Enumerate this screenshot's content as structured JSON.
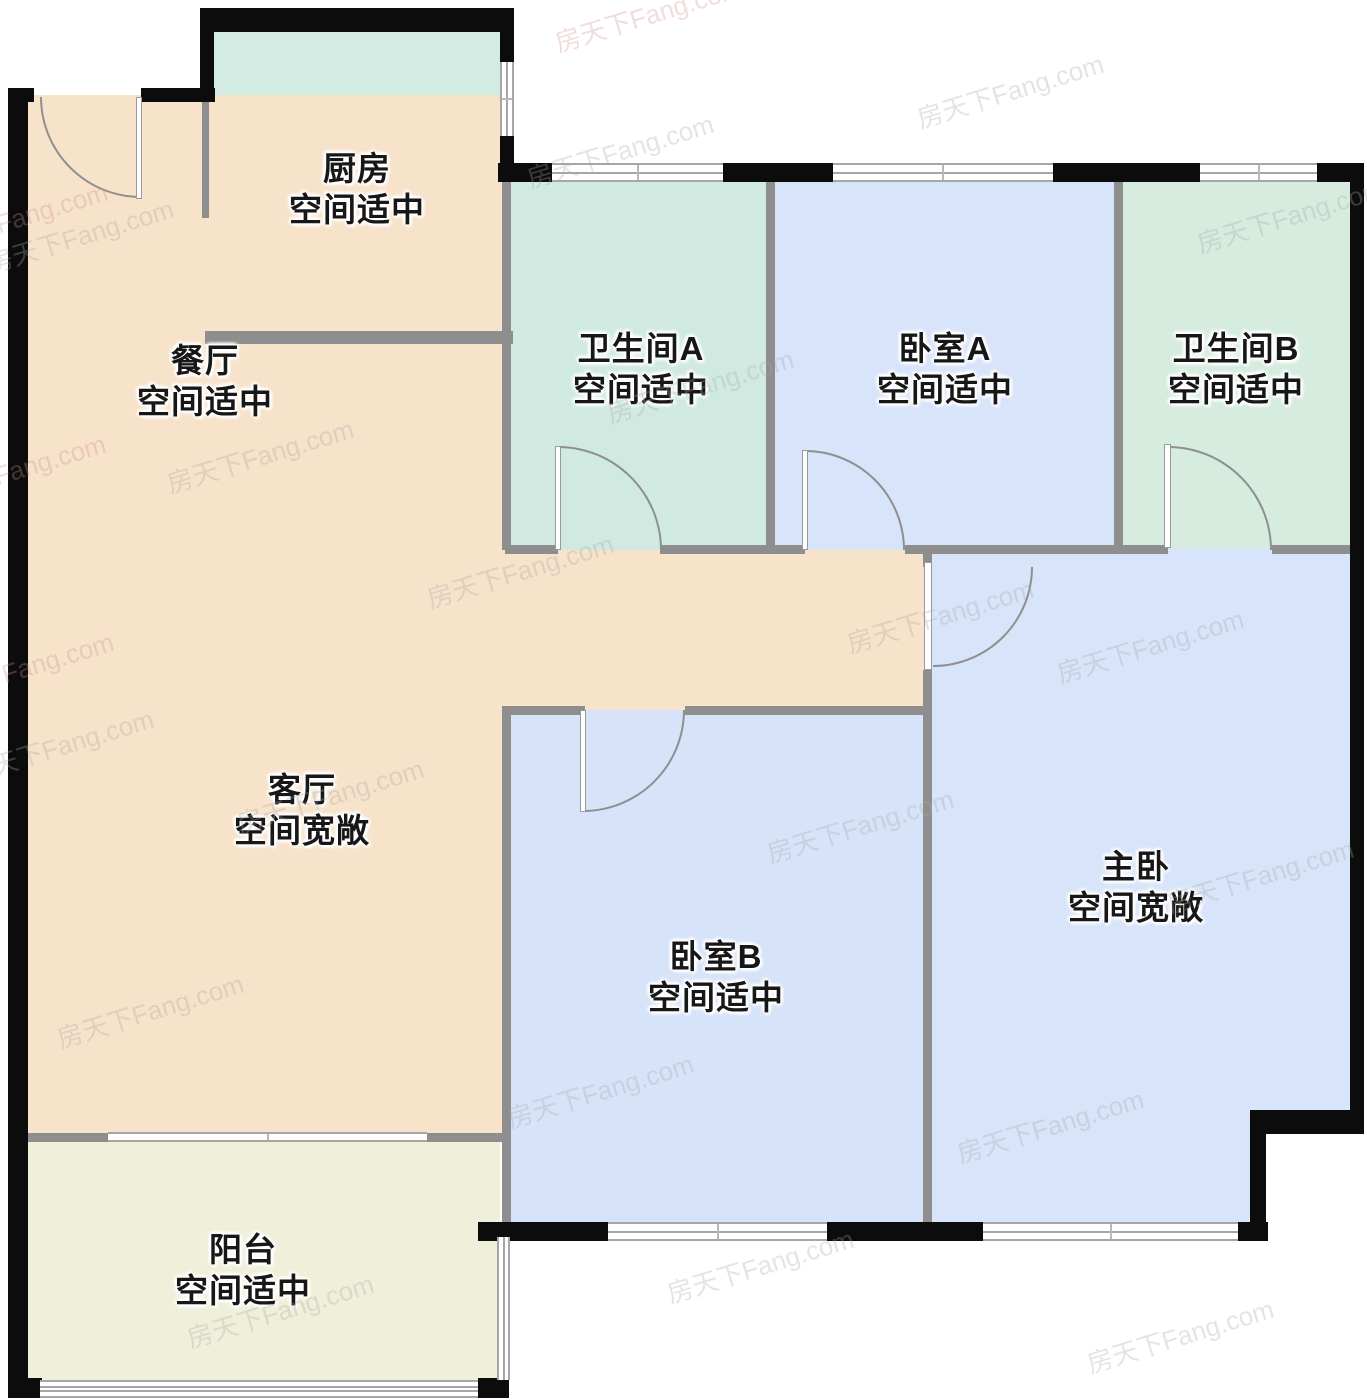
{
  "canvas": {
    "w": 1367,
    "h": 1400,
    "bg": "#ffffff"
  },
  "palette": {
    "outer_wall": "#0c0c0c",
    "partition": "#8e8e8e",
    "window_line": "#a6a6a6",
    "window_fill": "#ffffff",
    "door_line": "#8f8f8f",
    "label_color": "#171717",
    "kitchen_fill": "#d3ece3",
    "bath_fill": "#d0eae2",
    "bedroom_fill": "#d8e4f9",
    "living_fill": "#f7e2ca",
    "balcony_fill": "#f0efda"
  },
  "watermark": {
    "text": "房天下Fang.com",
    "color": "#a8a8a8",
    "opacity": 0.3,
    "accent_color": "#cf9090",
    "accent_opacity": 0.3,
    "positions": [
      [
        80,
        235
      ],
      [
        620,
        150
      ],
      [
        1010,
        90
      ],
      [
        1290,
        215
      ],
      [
        260,
        455
      ],
      [
        700,
        385
      ],
      [
        1150,
        645
      ],
      [
        60,
        745
      ],
      [
        520,
        570
      ],
      [
        940,
        615
      ],
      [
        330,
        795
      ],
      [
        860,
        825
      ],
      [
        1260,
        875
      ],
      [
        150,
        1010
      ],
      [
        600,
        1090
      ],
      [
        1050,
        1125
      ],
      [
        280,
        1310
      ],
      [
        760,
        1265
      ],
      [
        1180,
        1335
      ]
    ],
    "accent_positions": [
      [
        648,
        14
      ],
      [
        14,
        218
      ],
      [
        12,
        470
      ],
      [
        20,
        668
      ]
    ]
  },
  "rooms": [
    {
      "id": "kitchen",
      "name": "厨房",
      "note": "空间适中",
      "cx": 357,
      "cy": 189
    },
    {
      "id": "dining",
      "name": "餐厅",
      "note": "空间适中",
      "cx": 205,
      "cy": 381
    },
    {
      "id": "bath-a",
      "name": "卫生间A",
      "note": "空间适中",
      "cx": 641,
      "cy": 369
    },
    {
      "id": "bed-a",
      "name": "卧室A",
      "note": "空间适中",
      "cx": 945,
      "cy": 369
    },
    {
      "id": "bath-b",
      "name": "卫生间B",
      "note": "空间适中",
      "cx": 1236,
      "cy": 369
    },
    {
      "id": "living",
      "name": "客厅",
      "note": "空间宽敞",
      "cx": 302,
      "cy": 810
    },
    {
      "id": "bed-b",
      "name": "卧室B",
      "note": "空间适中",
      "cx": 716,
      "cy": 977
    },
    {
      "id": "master",
      "name": "主卧",
      "note": "空间宽敞",
      "cx": 1136,
      "cy": 887
    },
    {
      "id": "balcony",
      "name": "阳台",
      "note": "空间适中",
      "cx": 243,
      "cy": 1270
    }
  ],
  "areas": [
    {
      "id": "kitchen-floor",
      "color": "#d3ece3",
      "rect": [
        205,
        25,
        302,
        318
      ]
    },
    {
      "id": "dining-living-floor",
      "color": "#f7e2ca",
      "rect": [
        25,
        95,
        484,
        1046
      ]
    },
    {
      "id": "hall-floor",
      "color": "#f7e2ca",
      "rect": [
        505,
        548,
        420,
        162
      ]
    },
    {
      "id": "bath-a-floor",
      "color": "#d0eae2",
      "rect": [
        505,
        178,
        266,
        372
      ]
    },
    {
      "id": "bed-a-floor",
      "color": "#d8e4f9",
      "rect": [
        766,
        178,
        353,
        372
      ]
    },
    {
      "id": "bath-b-floor",
      "color": "#d6ecdf",
      "rect": [
        1118,
        178,
        240,
        372
      ]
    },
    {
      "id": "master-floor",
      "color": "#d8e4f9",
      "rect": [
        927,
        548,
        431,
        684
      ]
    },
    {
      "id": "bed-b-floor",
      "color": "#d6e3f8",
      "rect": [
        505,
        710,
        420,
        522
      ]
    },
    {
      "id": "balcony-floor",
      "color": "#f0efda",
      "rect": [
        25,
        1138,
        475,
        250
      ]
    },
    {
      "id": "notch-cutout",
      "color": "#ffffff",
      "rect": [
        1266,
        1133,
        101,
        112
      ]
    }
  ],
  "outer_walls": [
    [
      8,
      88,
      20,
      1310
    ],
    [
      8,
      88,
      26,
      14
    ],
    [
      141,
      88,
      74,
      14
    ],
    [
      200,
      8,
      14,
      94
    ],
    [
      200,
      8,
      313,
      24
    ],
    [
      500,
      8,
      14,
      56
    ],
    [
      500,
      136,
      14,
      46
    ],
    [
      498,
      163,
      56,
      19
    ],
    [
      723,
      163,
      110,
      19
    ],
    [
      1053,
      163,
      147,
      19
    ],
    [
      1317,
      163,
      47,
      19
    ],
    [
      1350,
      163,
      14,
      970
    ],
    [
      1250,
      1110,
      114,
      24
    ],
    [
      1250,
      1110,
      16,
      127
    ],
    [
      478,
      1222,
      131,
      19
    ],
    [
      827,
      1222,
      157,
      19
    ],
    [
      1238,
      1222,
      30,
      19
    ],
    [
      8,
      1378,
      34,
      20
    ],
    [
      478,
      1378,
      31,
      20
    ]
  ],
  "partitions": [
    [
      502,
      178,
      9,
      372
    ],
    [
      766,
      178,
      9,
      372
    ],
    [
      1114,
      178,
      9,
      372
    ],
    [
      505,
      545,
      53,
      9
    ],
    [
      660,
      545,
      145,
      9
    ],
    [
      905,
      545,
      263,
      9
    ],
    [
      1272,
      545,
      80,
      9
    ],
    [
      923,
      551,
      9,
      16
    ],
    [
      923,
      670,
      9,
      554
    ],
    [
      502,
      706,
      9,
      518
    ],
    [
      505,
      706,
      80,
      9
    ],
    [
      685,
      706,
      240,
      9
    ],
    [
      205,
      331,
      308,
      13
    ],
    [
      202,
      100,
      7,
      118
    ],
    [
      28,
      1133,
      82,
      9
    ],
    [
      427,
      1133,
      80,
      9
    ]
  ],
  "windows": [
    {
      "id": "window-bath-a-top",
      "rect": [
        552,
        163,
        171,
        19
      ],
      "o": "h",
      "inner": [
        0.5
      ],
      "tick": true
    },
    {
      "id": "window-bed-a-top",
      "rect": [
        833,
        163,
        220,
        19
      ],
      "o": "h",
      "inner": [
        0.5
      ],
      "tick": true
    },
    {
      "id": "window-bath-b-top",
      "rect": [
        1200,
        163,
        117,
        19
      ],
      "o": "h",
      "inner": [
        0.5
      ],
      "tick": true
    },
    {
      "id": "window-kitchen-right",
      "rect": [
        500,
        62,
        14,
        74
      ],
      "o": "v",
      "inner": [
        0.5
      ],
      "tick": true
    },
    {
      "id": "window-bed-b-bottom",
      "rect": [
        608,
        1222,
        219,
        19
      ],
      "o": "h",
      "inner": [
        0.5
      ],
      "tick": true
    },
    {
      "id": "window-master-bottom",
      "rect": [
        983,
        1222,
        255,
        19
      ],
      "o": "h",
      "inner": [
        0.5
      ],
      "tick": true
    },
    {
      "id": "balcony-rail-bottom",
      "rect": [
        40,
        1380,
        438,
        18
      ],
      "o": "h",
      "inner": [
        0.35,
        0.65
      ],
      "tick": false
    },
    {
      "id": "balcony-rail-right",
      "rect": [
        497,
        1237,
        13,
        143
      ],
      "o": "v",
      "inner": [
        0.5
      ],
      "tick": false
    },
    {
      "id": "balcony-slider",
      "rect": [
        108,
        1132,
        319,
        10
      ],
      "o": "h",
      "inner": [],
      "tick": true
    }
  ],
  "doors": [
    {
      "id": "door-entrance",
      "arc": [
        40,
        97,
        101,
        101
      ],
      "corner": "bl",
      "leaf": [
        136,
        97,
        6,
        102
      ]
    },
    {
      "id": "door-bath-a",
      "arc": [
        558,
        446,
        104,
        104
      ],
      "corner": "tr",
      "leaf": [
        555,
        446,
        6,
        104
      ]
    },
    {
      "id": "door-bed-a",
      "arc": [
        805,
        450,
        100,
        100
      ],
      "corner": "tr",
      "leaf": [
        802,
        450,
        6,
        100
      ]
    },
    {
      "id": "door-bath-b",
      "arc": [
        1168,
        446,
        104,
        104
      ],
      "corner": "tr",
      "leaf": [
        1164,
        444,
        7,
        104
      ]
    },
    {
      "id": "door-master",
      "arc": [
        933,
        567,
        100,
        100
      ],
      "corner": "br",
      "leaf": [
        924,
        562,
        8,
        108
      ]
    },
    {
      "id": "door-bed-b",
      "arc": [
        583,
        710,
        102,
        102
      ],
      "corner": "br",
      "leaf": [
        580,
        710,
        6,
        102
      ]
    }
  ]
}
